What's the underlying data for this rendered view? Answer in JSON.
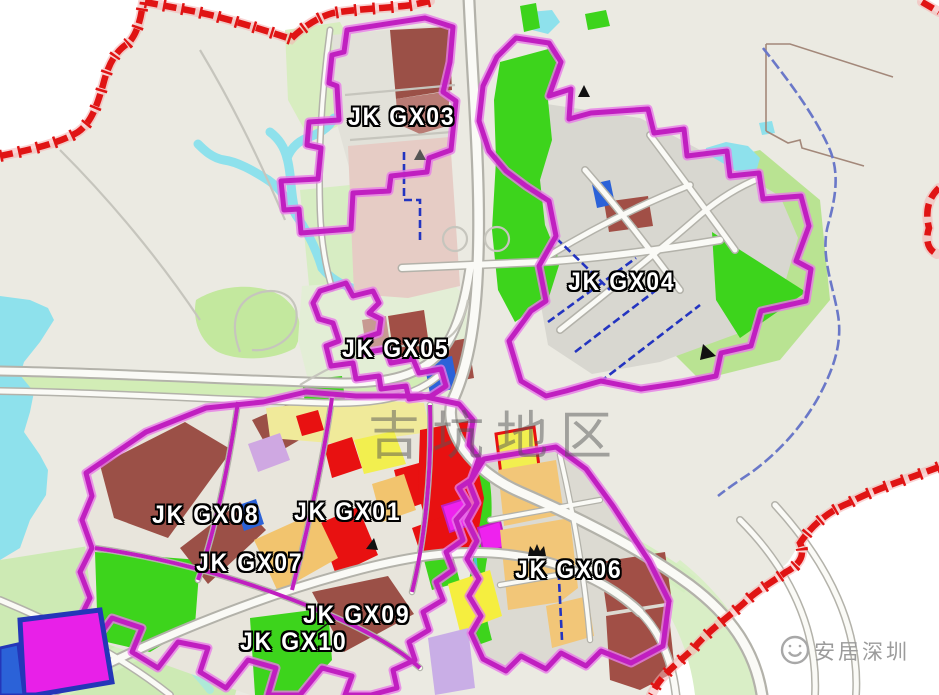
{
  "map": {
    "watermark_center": "吉坑地区",
    "brand": {
      "name": "安居深圳",
      "logo": "smiley-circle-logo"
    },
    "zones": [
      {
        "label": "JK GX03"
      },
      {
        "label": "JK GX04"
      },
      {
        "label": "JK GX05"
      },
      {
        "label": "JK GX01"
      },
      {
        "label": "JK GX08"
      },
      {
        "label": "JK GX07"
      },
      {
        "label": "JK GX09"
      },
      {
        "label": "JK GX10"
      },
      {
        "label": "JK GX06"
      }
    ],
    "markers": [
      {
        "name": "peak-marker-north"
      },
      {
        "name": "peak-marker-west"
      },
      {
        "name": "flag-marker-east"
      },
      {
        "name": "nav-marker-center"
      },
      {
        "name": "crown-marker-gx06"
      }
    ],
    "palette": {
      "background_outside": "#FFFFFF",
      "background_inside": "#EBEAE2",
      "boundary_red": "#E01414",
      "boundary_magenta": "#C01FC0",
      "water_cyan": "#8EE1EC",
      "park_green": "#3DD41C",
      "light_green": "#CDEAB4",
      "parcel_brown": "#9B5047",
      "parcel_red": "#E81111",
      "parcel_yellow": "#F2EF4F",
      "parcel_tan": "#F2C678",
      "parcel_magenta": "#EE22EE",
      "parcel_blue": "#2B62D8",
      "parcel_gray": "#D8D7D0",
      "road_white": "#FAFAF6",
      "planned_road_blue": "#2334C0",
      "watermark_gray": "#555555",
      "brand_gray": "#9B9B9B"
    }
  }
}
